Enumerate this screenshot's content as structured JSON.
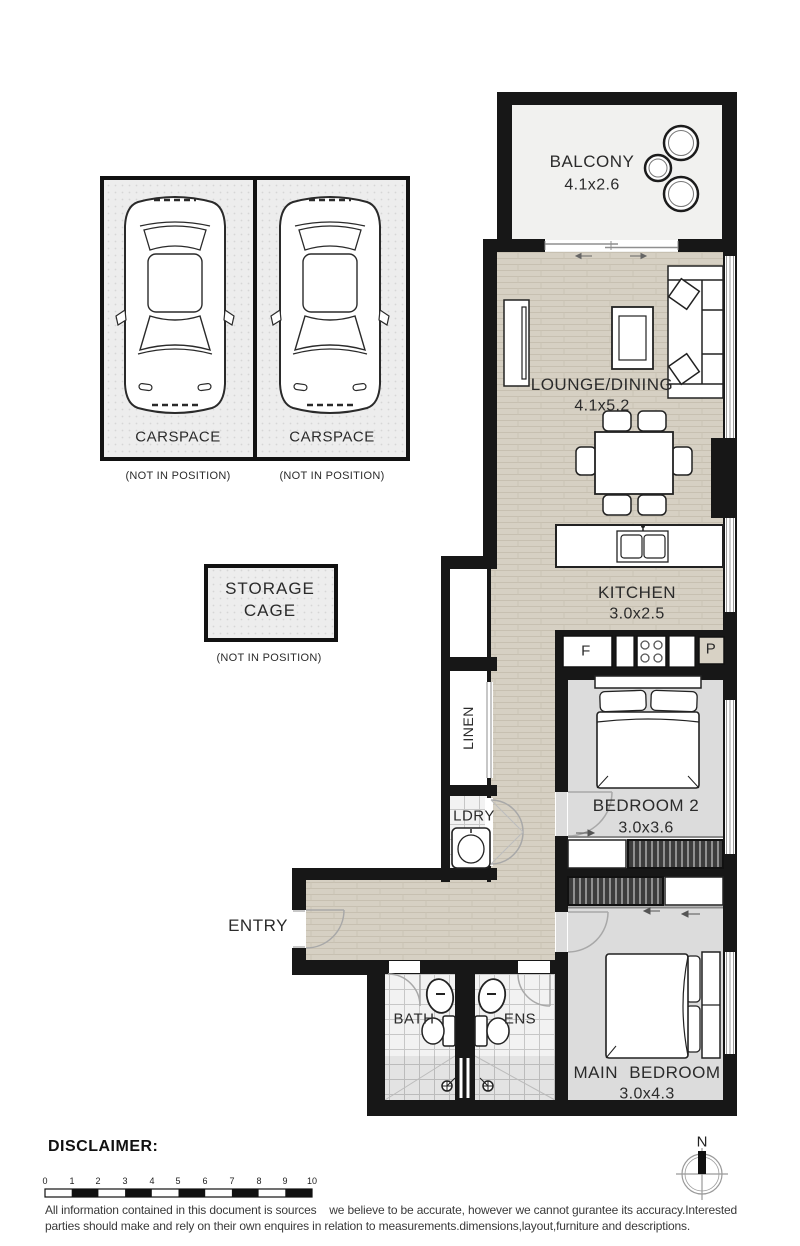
{
  "plan": {
    "balcony": {
      "name": "BALCONY",
      "dims": "4.1x2.6"
    },
    "lounge_dining": {
      "name": "LOUNGE/DINING",
      "dims": "4.1x5.2"
    },
    "kitchen": {
      "name": "KITCHEN",
      "dims": "3.0x2.5"
    },
    "bedroom_2": {
      "name": "BEDROOM 2",
      "dims": "3.0x3.6"
    },
    "main_bedroom": {
      "name": "MAIN BEDROOM",
      "dims": "3.0x4.3"
    },
    "bath": {
      "name": "BATH"
    },
    "ensuite": {
      "name": "ENS"
    },
    "laundry": {
      "name": "LDRY"
    },
    "linen": {
      "name": "LINEN"
    },
    "entry": {
      "name": "ENTRY"
    },
    "fridge_label": "F",
    "pantry_label": "P"
  },
  "parking": {
    "carspace_1": {
      "label": "CARSPACE",
      "note": "(NOT IN POSITION)"
    },
    "carspace_2": {
      "label": "CARSPACE",
      "note": "(NOT IN POSITION)"
    },
    "storage_cage": {
      "label": "STORAGE CAGE",
      "note": "(NOT IN POSITION)"
    }
  },
  "footer": {
    "heading": "DISCLAIMER:",
    "line1": "All information contained in this document is sources    we believe to be accurate, however we cannot gurantee its accuracy.Interested",
    "line2": "parties should make and rely on their own enquires in relation to measurements.dimensions,layout,furniture and descriptions.",
    "scale_ticks": [
      "0",
      "1",
      "2",
      "3",
      "4",
      "5",
      "6",
      "7",
      "8",
      "9",
      "10"
    ],
    "north": "N"
  },
  "colors": {
    "wall": "#171717",
    "floor_living": "#d6d0c3",
    "floor_bedroom": "#dcdcdc",
    "floor_balcony": "#f1f1ef",
    "tile": "#f2f2f2"
  }
}
